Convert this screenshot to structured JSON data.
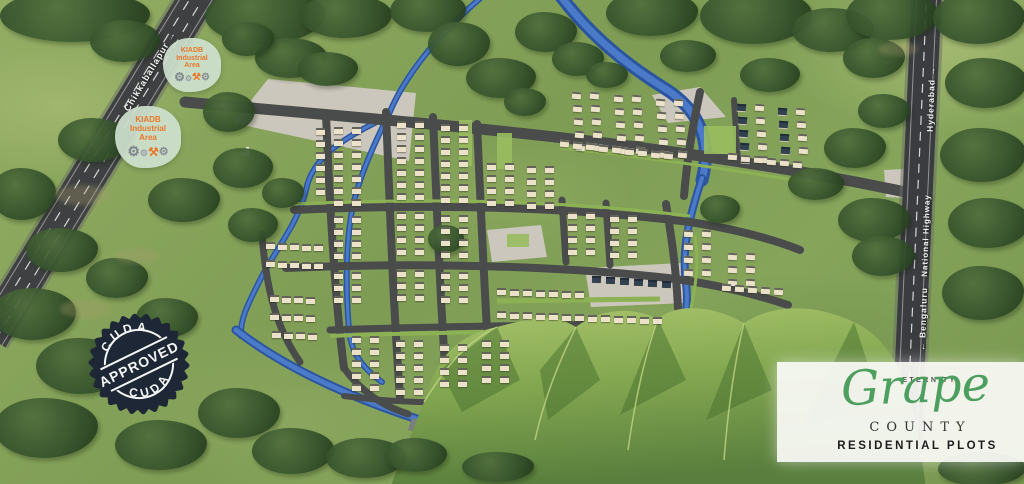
{
  "labels": {
    "left_road": "Chikkaballapur →",
    "highway_destination_north": "Hyderabad →",
    "highway_name": "National Highway",
    "highway_destination_south": "← Bengaluru"
  },
  "industrial_badges": [
    {
      "line1": "KIADB",
      "line2": "Industrial",
      "line3": "Area"
    },
    {
      "line1": "KIADB",
      "line2": "Industrial",
      "line3": "Area"
    }
  ],
  "approval_stamp": {
    "top": "CUDA",
    "center": "APPROVED",
    "bottom": "CUDA"
  },
  "logo": {
    "brand": "ETERNITY",
    "name": "Grape",
    "word": "COUNTY",
    "tagline": "RESIDENTIAL PLOTS"
  },
  "colors": {
    "river": "#2c55a0",
    "road": "#4a4c4b",
    "grass": "#86a55b",
    "stamp_navy": "#1d2735",
    "brand_green": "#4c9f5e",
    "kiadb_orange": "#e8772a",
    "plot_cream": "#ebe2c9",
    "hill_light": "#a3bf68"
  }
}
